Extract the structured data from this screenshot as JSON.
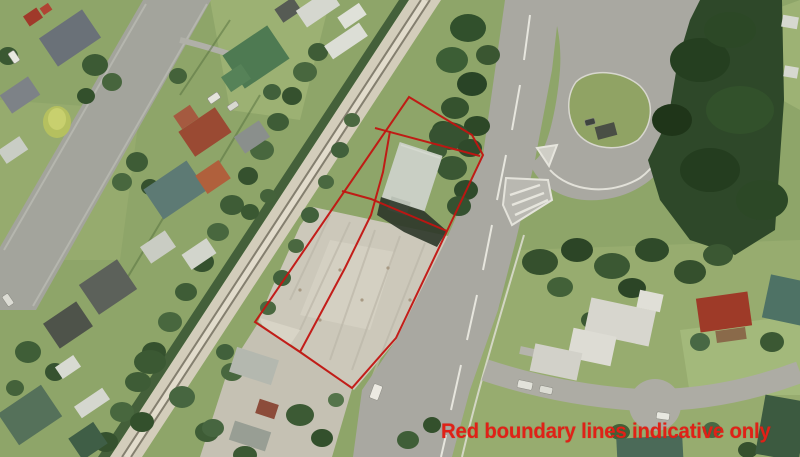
{
  "annotation": {
    "text": "Red boundary lines indicative only"
  },
  "palette": {
    "boundary_red": "#c21411",
    "note_red": "#e02117",
    "lawn_green": "#8ea569",
    "forest_green": "#2e4829",
    "road_gray": "#a9a8a1",
    "paving_gray": "#ccc8ba",
    "railway_beige": "#d3cdbb"
  },
  "boundary": {
    "outer": "409,97 472,135 483,155 447,231 396,338 352,388 300,352 255,322",
    "dividers": [
      "375,128 480,156",
      "390,131 383,172 371,215 345,268 300,352",
      "342,191 371,199 447,231"
    ]
  },
  "scenery": {
    "houses": [
      {
        "x": 70,
        "y": 38,
        "w": 52,
        "h": 34,
        "r": -34,
        "c": "#6a7178"
      },
      {
        "x": 33,
        "y": 17,
        "w": 16,
        "h": 12,
        "r": -34,
        "c": "#a0392a"
      },
      {
        "x": 46,
        "y": 9,
        "w": 10,
        "h": 8,
        "r": -34,
        "c": "#b04433"
      },
      {
        "x": 20,
        "y": 95,
        "w": 34,
        "h": 22,
        "r": -34,
        "c": "#7d8287"
      },
      {
        "x": 13,
        "y": 150,
        "w": 26,
        "h": 16,
        "r": -34,
        "c": "#c9cdc5"
      },
      {
        "x": 256,
        "y": 57,
        "w": 54,
        "h": 40,
        "r": -34,
        "c": "#4e7a52"
      },
      {
        "x": 236,
        "y": 78,
        "w": 24,
        "h": 18,
        "r": -34,
        "c": "#568258"
      },
      {
        "x": 205,
        "y": 132,
        "w": 44,
        "h": 30,
        "r": -34,
        "c": "#9a4a33"
      },
      {
        "x": 186,
        "y": 117,
        "w": 20,
        "h": 16,
        "r": -34,
        "c": "#a55a40"
      },
      {
        "x": 252,
        "y": 137,
        "w": 30,
        "h": 20,
        "r": -34,
        "c": "#8a8f8c"
      },
      {
        "x": 175,
        "y": 190,
        "w": 52,
        "h": 36,
        "r": -34,
        "c": "#5d7a74"
      },
      {
        "x": 213,
        "y": 177,
        "w": 28,
        "h": 22,
        "r": -34,
        "c": "#b0603c"
      },
      {
        "x": 108,
        "y": 287,
        "w": 46,
        "h": 36,
        "r": -34,
        "c": "#5c615a"
      },
      {
        "x": 68,
        "y": 325,
        "w": 40,
        "h": 30,
        "r": -34,
        "c": "#4e534a"
      },
      {
        "x": 30,
        "y": 415,
        "w": 52,
        "h": 38,
        "r": -34,
        "c": "#55715a"
      },
      {
        "x": 88,
        "y": 441,
        "w": 30,
        "h": 26,
        "r": -34,
        "c": "#3f5e46"
      },
      {
        "x": 68,
        "y": 367,
        "w": 22,
        "h": 14,
        "r": -34,
        "c": "#d8dad2"
      },
      {
        "x": 92,
        "y": 403,
        "w": 34,
        "h": 14,
        "r": -34,
        "c": "#d5d7cf"
      },
      {
        "x": 158,
        "y": 247,
        "w": 30,
        "h": 20,
        "r": -34,
        "c": "#c9ccc3"
      },
      {
        "x": 199,
        "y": 254,
        "w": 30,
        "h": 18,
        "r": -34,
        "c": "#d2d5cc"
      },
      {
        "x": 288,
        "y": 10,
        "w": 22,
        "h": 16,
        "r": -34,
        "c": "#565b54"
      },
      {
        "x": 318,
        "y": 8,
        "w": 40,
        "h": 20,
        "r": -34,
        "c": "#d5d7cf"
      },
      {
        "x": 352,
        "y": 16,
        "w": 26,
        "h": 14,
        "r": -34,
        "c": "#dfe1d9"
      },
      {
        "x": 346,
        "y": 41,
        "w": 42,
        "h": 16,
        "r": -34,
        "c": "#dcded6"
      },
      {
        "x": 254,
        "y": 366,
        "w": 44,
        "h": 26,
        "r": 18,
        "c": "#b4b8af"
      },
      {
        "x": 267,
        "y": 409,
        "w": 20,
        "h": 15,
        "r": 18,
        "c": "#8c4c3a"
      },
      {
        "x": 250,
        "y": 436,
        "w": 38,
        "h": 20,
        "r": 18,
        "c": "#989e94"
      },
      {
        "x": 724,
        "y": 312,
        "w": 52,
        "h": 34,
        "r": -8,
        "c": "#9e3a28"
      },
      {
        "x": 731,
        "y": 335,
        "w": 30,
        "h": 12,
        "r": -8,
        "c": "#8a6a4a"
      },
      {
        "x": 786,
        "y": 300,
        "w": 40,
        "h": 44,
        "r": 12,
        "c": "#4e7265"
      },
      {
        "x": 620,
        "y": 322,
        "w": 66,
        "h": 36,
        "r": 12,
        "c": "#d7d6ce"
      },
      {
        "x": 592,
        "y": 347,
        "w": 44,
        "h": 30,
        "r": 12,
        "c": "#dddcd4"
      },
      {
        "x": 650,
        "y": 301,
        "w": 24,
        "h": 18,
        "r": 12,
        "c": "#e0dfd7"
      },
      {
        "x": 556,
        "y": 362,
        "w": 48,
        "h": 28,
        "r": 12,
        "c": "#d2d1c9"
      },
      {
        "x": 650,
        "y": 452,
        "w": 66,
        "h": 30,
        "r": -3,
        "c": "#4b6a58"
      },
      {
        "x": 782,
        "y": 428,
        "w": 44,
        "h": 60,
        "r": 10,
        "c": "#3c5a40"
      },
      {
        "x": 790,
        "y": 22,
        "w": 16,
        "h": 12,
        "r": 10,
        "c": "#d6d8d0"
      },
      {
        "x": 791,
        "y": 72,
        "w": 14,
        "h": 11,
        "r": 10,
        "c": "#d6d8d0"
      },
      {
        "x": 606,
        "y": 131,
        "w": 20,
        "h": 13,
        "r": -15,
        "c": "#4a4f45"
      },
      {
        "x": 412,
        "y": 177,
        "w": 45,
        "h": 59,
        "r": 18,
        "c": "#c9cfc4"
      },
      {
        "x": 399,
        "y": 206,
        "w": 20,
        "h": 14,
        "r": 18,
        "c": "#b9c0b5"
      }
    ],
    "trees": [
      {
        "x": 318,
        "y": 52,
        "rx": 10,
        "ry": 9,
        "c": "#3e5c36"
      },
      {
        "x": 305,
        "y": 72,
        "rx": 12,
        "ry": 10,
        "c": "#48673e"
      },
      {
        "x": 292,
        "y": 96,
        "rx": 10,
        "ry": 9,
        "c": "#35512e"
      },
      {
        "x": 278,
        "y": 122,
        "rx": 11,
        "ry": 9,
        "c": "#3e5c36"
      },
      {
        "x": 262,
        "y": 150,
        "rx": 12,
        "ry": 10,
        "c": "#48673e"
      },
      {
        "x": 248,
        "y": 176,
        "rx": 10,
        "ry": 9,
        "c": "#35512e"
      },
      {
        "x": 232,
        "y": 205,
        "rx": 12,
        "ry": 10,
        "c": "#3e5c36"
      },
      {
        "x": 218,
        "y": 232,
        "rx": 11,
        "ry": 9,
        "c": "#48673e"
      },
      {
        "x": 202,
        "y": 262,
        "rx": 12,
        "ry": 10,
        "c": "#35512e"
      },
      {
        "x": 186,
        "y": 292,
        "rx": 11,
        "ry": 9,
        "c": "#3e5c36"
      },
      {
        "x": 170,
        "y": 322,
        "rx": 12,
        "ry": 10,
        "c": "#48673e"
      },
      {
        "x": 154,
        "y": 352,
        "rx": 12,
        "ry": 10,
        "c": "#35512e"
      },
      {
        "x": 138,
        "y": 382,
        "rx": 13,
        "ry": 10,
        "c": "#3e5c36"
      },
      {
        "x": 122,
        "y": 412,
        "rx": 12,
        "ry": 10,
        "c": "#48673e"
      },
      {
        "x": 106,
        "y": 442,
        "rx": 12,
        "ry": 10,
        "c": "#35512e"
      },
      {
        "x": 352,
        "y": 120,
        "rx": 8,
        "ry": 7,
        "c": "#4a6840"
      },
      {
        "x": 340,
        "y": 150,
        "rx": 9,
        "ry": 8,
        "c": "#41603b"
      },
      {
        "x": 326,
        "y": 182,
        "rx": 8,
        "ry": 7,
        "c": "#4a6840"
      },
      {
        "x": 310,
        "y": 215,
        "rx": 9,
        "ry": 8,
        "c": "#41603b"
      },
      {
        "x": 296,
        "y": 246,
        "rx": 8,
        "ry": 7,
        "c": "#4a6840"
      },
      {
        "x": 282,
        "y": 278,
        "rx": 9,
        "ry": 8,
        "c": "#41603b"
      },
      {
        "x": 268,
        "y": 308,
        "rx": 8,
        "ry": 7,
        "c": "#4a6840"
      },
      {
        "x": 95,
        "y": 65,
        "rx": 13,
        "ry": 11,
        "c": "#3c5a34"
      },
      {
        "x": 112,
        "y": 82,
        "rx": 10,
        "ry": 9,
        "c": "#47653d"
      },
      {
        "x": 86,
        "y": 96,
        "rx": 9,
        "ry": 8,
        "c": "#33502c"
      },
      {
        "x": 137,
        "y": 162,
        "rx": 11,
        "ry": 10,
        "c": "#3e5c36"
      },
      {
        "x": 122,
        "y": 182,
        "rx": 10,
        "ry": 9,
        "c": "#48673e"
      },
      {
        "x": 150,
        "y": 187,
        "rx": 9,
        "ry": 8,
        "c": "#35512e"
      },
      {
        "x": 8,
        "y": 56,
        "rx": 10,
        "ry": 9,
        "c": "#3a5832"
      },
      {
        "x": 178,
        "y": 76,
        "rx": 9,
        "ry": 8,
        "c": "#44623a"
      },
      {
        "x": 57,
        "y": 122,
        "rx": 14,
        "ry": 16,
        "c": "#b5c05f"
      },
      {
        "x": 57,
        "y": 119,
        "rx": 9,
        "ry": 11,
        "c": "#c8d06e"
      },
      {
        "x": 150,
        "y": 362,
        "rx": 16,
        "ry": 12,
        "c": "#3b5933"
      },
      {
        "x": 182,
        "y": 397,
        "rx": 13,
        "ry": 11,
        "c": "#476640"
      },
      {
        "x": 142,
        "y": 422,
        "rx": 12,
        "ry": 10,
        "c": "#33502c"
      },
      {
        "x": 207,
        "y": 432,
        "rx": 12,
        "ry": 10,
        "c": "#3e5c36"
      },
      {
        "x": 232,
        "y": 372,
        "rx": 11,
        "ry": 9,
        "c": "#48673e"
      },
      {
        "x": 28,
        "y": 352,
        "rx": 13,
        "ry": 11,
        "c": "#3f5e37"
      },
      {
        "x": 55,
        "y": 372,
        "rx": 10,
        "ry": 9,
        "c": "#365230"
      },
      {
        "x": 15,
        "y": 388,
        "rx": 9,
        "ry": 8,
        "c": "#44623a"
      },
      {
        "x": 250,
        "y": 212,
        "rx": 9,
        "ry": 8,
        "c": "#3a5832"
      },
      {
        "x": 268,
        "y": 196,
        "rx": 8,
        "ry": 7,
        "c": "#44623a"
      },
      {
        "x": 253,
        "y": 68,
        "rx": 12,
        "ry": 10,
        "c": "#35522e"
      },
      {
        "x": 272,
        "y": 92,
        "rx": 9,
        "ry": 8,
        "c": "#41603b"
      },
      {
        "x": 468,
        "y": 28,
        "rx": 18,
        "ry": 14,
        "c": "#31502c"
      },
      {
        "x": 452,
        "y": 60,
        "rx": 16,
        "ry": 13,
        "c": "#3c5e35"
      },
      {
        "x": 472,
        "y": 84,
        "rx": 15,
        "ry": 12,
        "c": "#294426"
      },
      {
        "x": 455,
        "y": 108,
        "rx": 14,
        "ry": 11,
        "c": "#35522e"
      },
      {
        "x": 477,
        "y": 126,
        "rx": 13,
        "ry": 10,
        "c": "#2d4827"
      },
      {
        "x": 488,
        "y": 55,
        "rx": 12,
        "ry": 10,
        "c": "#3a5631"
      },
      {
        "x": 443,
        "y": 130,
        "rx": 11,
        "ry": 9,
        "c": "#31502c"
      },
      {
        "x": 449,
        "y": 136,
        "rx": 20,
        "ry": 14,
        "c": "#365231"
      },
      {
        "x": 470,
        "y": 148,
        "rx": 12,
        "ry": 9,
        "c": "#2f4a2b"
      },
      {
        "x": 452,
        "y": 168,
        "rx": 15,
        "ry": 12,
        "c": "#3a5733"
      },
      {
        "x": 466,
        "y": 190,
        "rx": 12,
        "ry": 10,
        "c": "#2f4a2b"
      },
      {
        "x": 459,
        "y": 206,
        "rx": 12,
        "ry": 10,
        "c": "#355130"
      },
      {
        "x": 437,
        "y": 151,
        "rx": 10,
        "ry": 8,
        "c": "#3e5b36"
      },
      {
        "x": 540,
        "y": 262,
        "rx": 18,
        "ry": 13,
        "c": "#35502d"
      },
      {
        "x": 577,
        "y": 250,
        "rx": 16,
        "ry": 12,
        "c": "#2c4526"
      },
      {
        "x": 612,
        "y": 266,
        "rx": 18,
        "ry": 13,
        "c": "#3b5833"
      },
      {
        "x": 652,
        "y": 250,
        "rx": 17,
        "ry": 12,
        "c": "#2f4a29"
      },
      {
        "x": 690,
        "y": 272,
        "rx": 16,
        "ry": 12,
        "c": "#35502d"
      },
      {
        "x": 560,
        "y": 287,
        "rx": 13,
        "ry": 10,
        "c": "#426138"
      },
      {
        "x": 632,
        "y": 288,
        "rx": 14,
        "ry": 10,
        "c": "#2c4526"
      },
      {
        "x": 718,
        "y": 255,
        "rx": 15,
        "ry": 11,
        "c": "#3b5833"
      },
      {
        "x": 700,
        "y": 342,
        "rx": 10,
        "ry": 9,
        "c": "#486844"
      },
      {
        "x": 772,
        "y": 342,
        "rx": 12,
        "ry": 10,
        "c": "#3b5833"
      },
      {
        "x": 620,
        "y": 432,
        "rx": 10,
        "ry": 8,
        "c": "#426138"
      },
      {
        "x": 712,
        "y": 430,
        "rx": 9,
        "ry": 8,
        "c": "#486844"
      },
      {
        "x": 748,
        "y": 450,
        "rx": 10,
        "ry": 8,
        "c": "#35502d"
      },
      {
        "x": 590,
        "y": 320,
        "rx": 9,
        "ry": 8,
        "c": "#3b5833"
      },
      {
        "x": 225,
        "y": 352,
        "rx": 9,
        "ry": 8,
        "c": "#41603b"
      },
      {
        "x": 300,
        "y": 415,
        "rx": 14,
        "ry": 11,
        "c": "#3c5a34"
      },
      {
        "x": 322,
        "y": 438,
        "rx": 11,
        "ry": 9,
        "c": "#33502c"
      },
      {
        "x": 213,
        "y": 428,
        "rx": 11,
        "ry": 9,
        "c": "#476640"
      },
      {
        "x": 245,
        "y": 455,
        "rx": 12,
        "ry": 9,
        "c": "#3b5933"
      },
      {
        "x": 336,
        "y": 400,
        "rx": 8,
        "ry": 7,
        "c": "#54744a"
      },
      {
        "x": 408,
        "y": 440,
        "rx": 11,
        "ry": 9,
        "c": "#3f5e37"
      },
      {
        "x": 432,
        "y": 425,
        "rx": 9,
        "ry": 8,
        "c": "#33502c"
      },
      {
        "x": 700,
        "y": 60,
        "rx": 30,
        "ry": 22,
        "c": "#253f20"
      },
      {
        "x": 740,
        "y": 110,
        "rx": 34,
        "ry": 24,
        "c": "#32512b"
      },
      {
        "x": 710,
        "y": 170,
        "rx": 30,
        "ry": 22,
        "c": "#243d1f"
      },
      {
        "x": 762,
        "y": 200,
        "rx": 26,
        "ry": 20,
        "c": "#2c4826"
      },
      {
        "x": 672,
        "y": 120,
        "rx": 20,
        "ry": 16,
        "c": "#1f3519"
      },
      {
        "x": 730,
        "y": 30,
        "rx": 26,
        "ry": 18,
        "c": "#2c4826"
      }
    ],
    "vehicles": [
      {
        "x": 14,
        "y": 57,
        "w": 12,
        "h": 7,
        "r": 56,
        "c": "#e8e8e0"
      },
      {
        "x": 8,
        "y": 300,
        "w": 12,
        "h": 7,
        "r": 56,
        "c": "#dcdcd4"
      },
      {
        "x": 214,
        "y": 98,
        "w": 12,
        "h": 7,
        "r": -34,
        "c": "#e4e4dc"
      },
      {
        "x": 233,
        "y": 106,
        "w": 11,
        "h": 6,
        "r": -34,
        "c": "#d8d8d0"
      },
      {
        "x": 376,
        "y": 392,
        "w": 9,
        "h": 15,
        "r": 20,
        "c": "#eceae2"
      },
      {
        "x": 525,
        "y": 385,
        "w": 15,
        "h": 8,
        "r": 12,
        "c": "#e2e2da"
      },
      {
        "x": 546,
        "y": 390,
        "w": 13,
        "h": 7,
        "r": 12,
        "c": "#dcdcd4"
      },
      {
        "x": 663,
        "y": 416,
        "w": 13,
        "h": 7,
        "r": 8,
        "c": "#e8e8e0"
      },
      {
        "x": 590,
        "y": 122,
        "w": 10,
        "h": 6,
        "r": -15,
        "c": "#3f453f"
      }
    ]
  }
}
